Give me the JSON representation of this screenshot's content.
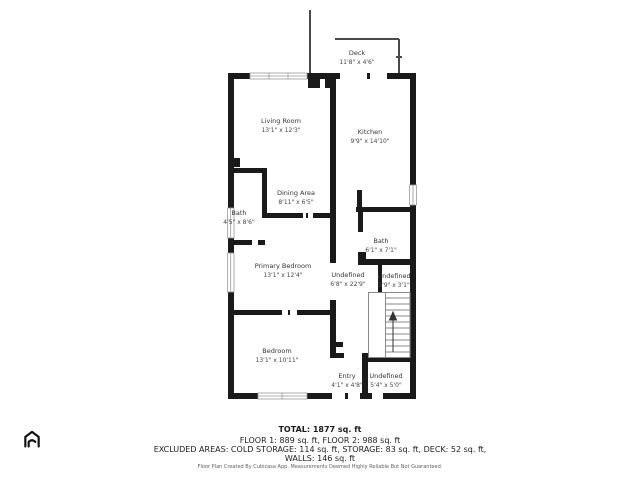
{
  "floorplan": {
    "rooms": [
      {
        "name": "Deck",
        "dims": "11'8\" x 4'6\""
      },
      {
        "name": "Living Room",
        "dims": "13'1\" x 12'3\""
      },
      {
        "name": "Kitchen",
        "dims": "9'9\" x 14'10\""
      },
      {
        "name": "Dining Area",
        "dims": "8'11\" x 6'5\""
      },
      {
        "name": "Bath",
        "dims": "4'5\" x 8'6\""
      },
      {
        "name": "Primary Bedroom",
        "dims": "13'1\" x 12'4\""
      },
      {
        "name": "Bath",
        "dims": "6'1\" x 7'1\""
      },
      {
        "name": "Undefined",
        "dims": "6'8\" x 22'9\""
      },
      {
        "name": "Undefined",
        "dims": "3'9\" x 3'1\""
      },
      {
        "name": "Bedroom",
        "dims": "13'1\" x 10'11\""
      },
      {
        "name": "Entry",
        "dims": "4'1\" x 4'8\""
      },
      {
        "name": "Undefined",
        "dims": "5'4\" x 5'0\""
      }
    ],
    "footer": {
      "total": "TOTAL: 1877 sq. ft",
      "floors": "FLOOR 1: 889 sq. ft, FLOOR 2: 988 sq. ft",
      "excluded": "EXCLUDED AREAS: COLD STORAGE: 114 sq. ft, STORAGE: 83 sq. ft, DECK: 52 sq. ft,",
      "walls": "WALLS: 146 sq. ft",
      "disclaimer": "Floor Plan Created By Cubicasa App. Measurements Deemed Highly Reliable But Not Guaranteed."
    },
    "colors": {
      "wall": "#1a1a1a",
      "window_frame": "#9a9a9a",
      "stairs": "#8a8a8a",
      "disclaimer_text": "#5f5f5f"
    }
  }
}
